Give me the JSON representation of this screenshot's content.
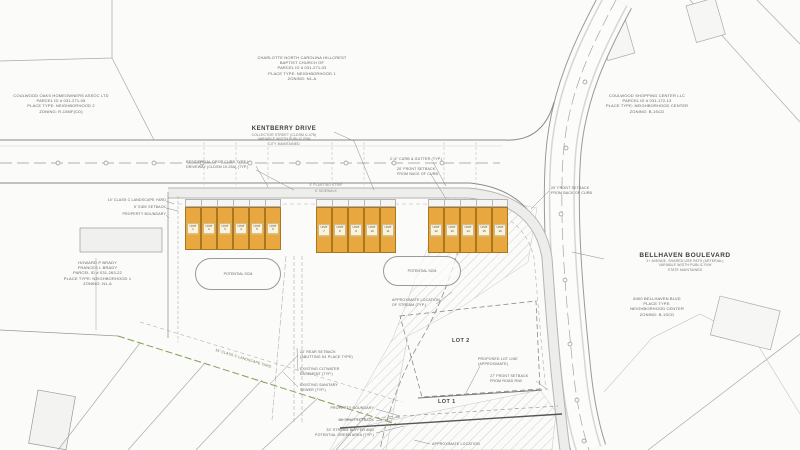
{
  "parcels": {
    "church": {
      "l1": "CHARLOTTE NORTH CAROLINA HILLCREST",
      "l2": "BAPTIST CHURCH OF",
      "l3": "PARCEL ID # 031-271-03",
      "l4": "PLACE TYPE: NEIGHBORHOOD 1",
      "l5": "ZONING: N1-A"
    },
    "coulwood_oaks": {
      "l1": "COULWOOD OAKS HOMEOWNERS ASSOC LTD",
      "l2": "PARCEL ID # 031-271-05",
      "l3": "PLACE TYPE: NEIGHBORHOOD 2",
      "l4": "ZONING: R-15MF(CD)"
    },
    "shopping_center": {
      "l1": "COULWOOD SHOPPING CENTER LLC",
      "l2": "PARCEL ID # 031-172-13",
      "l3": "PLACE TYPE: NEIGHBORHOOD CENTER",
      "l4": "ZONING: B-1SCD"
    },
    "brady": {
      "l1": "HOWARD P BRADY",
      "l2": "FRANCES L BRADY",
      "l3": "PARCEL ID # 031-263-22",
      "l4": "PLACE TYPE: NEIGHBORHOOD 1",
      "l5": "ZONING: N1-A"
    },
    "bellhaven_site": {
      "l1": "8400 BELLHAVEN BLVD",
      "l2": "PLACE TYPE:",
      "l3": "NEIGHBORHOOD CENTER",
      "l4": "ZONING: B-1SCD"
    }
  },
  "roads": {
    "kentberry": {
      "name": "KENTBERRY DRIVE",
      "sub1": "COLLECTOR STREET (CLDSM U-478)",
      "sub2": "VARIABLE WIDTH PUBLIC R/W",
      "sub3": "CITY MAINTAINED"
    },
    "bellhaven": {
      "name": "BELLHAVEN BOULEVARD",
      "sub1": "2+ AVENUE, SHARED-USE PATH (ARTERIAL)",
      "sub2": "VARIABLE WIDTH PUBLIC R/W",
      "sub3": "STATE MAINTAINED"
    },
    "planting_strip": "5' PLANTING STRIP",
    "sidewalk": "6' SIDEWALK"
  },
  "callouts": {
    "drop_curb_1": "RESIDENTIAL DROP CURB TYPE I",
    "drop_curb_2": "DRIVEWAY (CLDSM 10.25A) (TYP.)",
    "curb_gutter": "2'-6\" CURB & GUTTER (TYP.)",
    "front_setback_1": "20' FRONT SETBACK",
    "front_setback_2": "FROM BACK OF CURB",
    "landscape_10": "10' CLASS C LANDSCAPE YARD",
    "side_setback": "5' SIDE SETBACK",
    "property_boundary": "PROPERTY BOUNDARY",
    "landscape_16": "16' CLASS C LANDSCAPE YARD",
    "rear_setback_1": "20' REAR SETBACK",
    "rear_setback_2": "(ABUTTING N1 PLACE TYPE)",
    "water_1": "EXISTING CLTWATER",
    "water_2": "EASEMENT (TYP.)",
    "sewer_1": "EXISTING SANITARY",
    "sewer_2": "SEWER (TYP.)",
    "stream_1": "APPROXIMATE LOCATION",
    "stream_2": "OF STREAM (TYP.)",
    "lot_line_1": "PROPOSED LOT LINE",
    "lot_line_2": "(APPROXIMATE)",
    "road_setback_1": "27' FRONT SETBACK",
    "road_setback_2": "FROM ROAD R/W",
    "rear_40": "40' REAR SETBACK",
    "buffer_1": "30' STREAM BUFFER AND",
    "buffer_2": "POTENTIAL GREEN AREA (TYP.)",
    "approx_loc": "APPROXIMATE LOCATION"
  },
  "site": {
    "scm": "POTENTIAL SCM",
    "lot1": "LOT 1",
    "lot2": "LOT 2",
    "unit_word": "UNIT",
    "unit_numbers": [
      "1",
      "2",
      "3",
      "4",
      "5",
      "6",
      "7",
      "8",
      "9",
      "10",
      "11",
      "12",
      "13",
      "14",
      "15",
      "16"
    ]
  },
  "colors": {
    "unit_fill": "#E9A83F",
    "unit_border": "#A8771F",
    "unit_label_bg": "#FBF3DC",
    "landscape_green": "#7F9F4F",
    "road_gray": "#8A8A8A",
    "hatch_line": "#CFCFCF"
  }
}
